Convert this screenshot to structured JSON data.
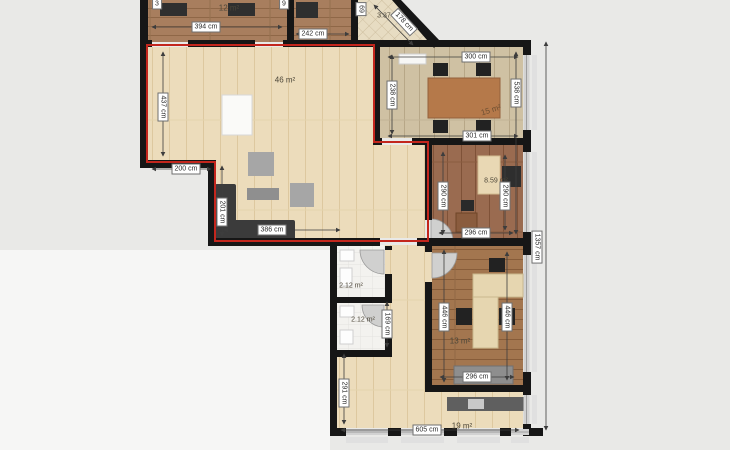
{
  "areas": {
    "top_left_room": "12 m²",
    "balcony": "3.37 m²",
    "living_room": "46 m²",
    "meeting_room": "15 m²",
    "middle_room": "8.59 m²",
    "bathroom_top": "2.12 m²",
    "bathroom_bottom": "2.12 m²",
    "office_room": "13 m²",
    "hall": "19 m²"
  },
  "dimensions": {
    "top_left_width": "394 cm",
    "top_mid_width": "242 cm",
    "balcony_diagonal": "178 cm",
    "meeting_top": "300 cm",
    "meeting_bottom": "301 cm",
    "meeting_left": "238 cm",
    "right_span": "538 cm",
    "middle_left": "290 cm",
    "middle_right": "290 cm",
    "middle_bottom": "296 cm",
    "office_left": "446 cm",
    "office_right": "446 cm",
    "office_bottom": "296 cm",
    "living_left": "437 cm",
    "living_step": "200 cm",
    "living_side": "201 cm",
    "living_bottom": "386 cm",
    "bath_right": "169 cm",
    "hall_left": "291 cm",
    "hall_bottom": "605 cm",
    "building_right": "1357 cm",
    "cut_top_a": "3",
    "cut_top_b": "9",
    "cut_top_c": "69"
  },
  "colors": {
    "accent_red": "#c3261d",
    "wall": "#161616",
    "living_floor": "#ecdcbb",
    "dark_wood": "#a87e5e",
    "red_wood": "#9a6b50",
    "meeting_floor": "#cfc1a3",
    "office_wood": "#a3764f",
    "window": "#d2d2d2"
  }
}
